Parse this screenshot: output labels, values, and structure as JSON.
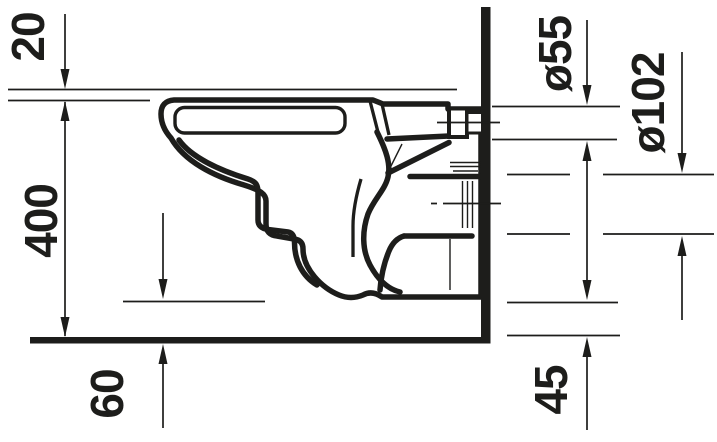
{
  "document": {
    "kind": "technical dimension drawing",
    "subject": "wall-hung toilet, side section",
    "background": "#ffffff",
    "ink": "#1d1d1b"
  },
  "dimensions": {
    "seat_offset": "20",
    "height": "400",
    "underside_clearance": "60",
    "flush_connection": "ø55",
    "outlet": "ø102",
    "outlet_clearance": "45"
  }
}
